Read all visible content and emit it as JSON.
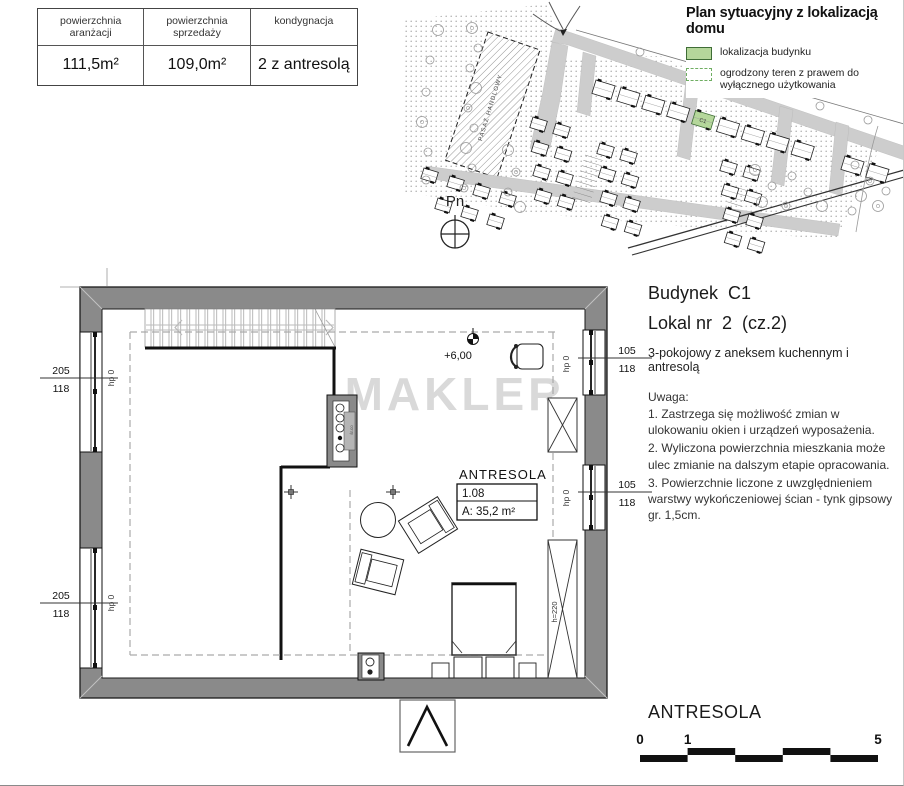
{
  "info_table": {
    "headers": [
      "powierzchnia aranżacji",
      "powierzchnia sprzedaży",
      "kondygnacja"
    ],
    "values": [
      "111,5m²",
      "109,0m²",
      "2 z antresolą"
    ]
  },
  "site_plan": {
    "title": "Plan sytuacyjny z lokalizacją domu",
    "legend": [
      {
        "label": "lokalizacja budynku"
      },
      {
        "label": "ogrodzony teren z prawem do wyłącznego użytkowania"
      }
    ],
    "highlight_label": "C1",
    "highlight_color": "#b5d79b",
    "pavilion_label": "PASAŻ HANDLOWY",
    "compass_label": "Pn"
  },
  "unit_header": {
    "building": "Budynek  C1",
    "unit": "Lokal nr  2  (cz.2)",
    "description": "3-pokojowy z aneksem kuchennym i antresolą"
  },
  "notes": {
    "title": "Uwaga:",
    "items": [
      "1. Zastrzega się możliwość zmian w ulokowaniu okien i urządzeń wyposażenia.",
      "2. Wyliczona powierzchnia mieszkania może ulec zmianie na dalszym etapie opracowania.",
      "3. Powierzchnie liczone z uwzględnieniem warstwy wykończeniowej ścian - tynk gipsowy gr. 1,5cm."
    ]
  },
  "floor_plan": {
    "watermark": "MAKLER",
    "level_marker": "+6,00",
    "room": {
      "name": "ANTRESOLA",
      "number": "1.08",
      "area": "A: 35,2 m²"
    },
    "windows": {
      "left": [
        {
          "size": "205",
          "height": "118",
          "sill": "hp 0"
        },
        {
          "size": "205",
          "height": "118",
          "sill": "hp 0"
        }
      ],
      "right": [
        {
          "size": "105",
          "height": "118",
          "sill": "hp 0"
        },
        {
          "size": "105",
          "height": "118",
          "sill": "hp 0"
        }
      ]
    },
    "annotations": {
      "height_label": "h=220",
      "shaft_label": "śr.co"
    }
  },
  "footer": {
    "title": "ANTRESOLA",
    "scale_ticks": [
      "0",
      "1",
      "5"
    ]
  }
}
